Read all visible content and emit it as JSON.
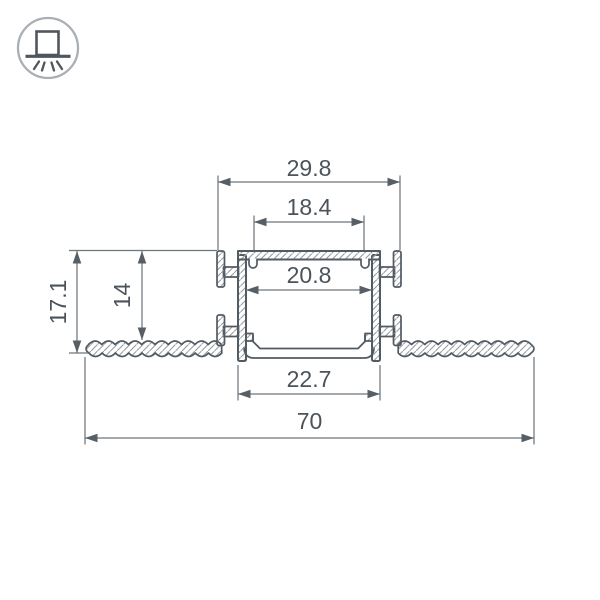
{
  "page": {
    "background": "#ffffff"
  },
  "badge": {
    "icon": "recessed-ceiling-light-icon"
  },
  "drawing": {
    "type": "led-profile-cross-section",
    "dimensions": {
      "mounting_tabs_width": "29.8",
      "top_opening_width": "18.4",
      "inner_cavity_width": "20.8",
      "recess_depth": "14",
      "overall_height": "17.1",
      "bottom_body_width": "22.7",
      "overall_width": "70"
    },
    "colors": {
      "outline": "#525a62",
      "dimension_line": "#6e767e",
      "arrow": "#565e66",
      "hatch": "#949ba1",
      "text": "#4b535b",
      "icon_circle": "#a9afb5"
    }
  }
}
